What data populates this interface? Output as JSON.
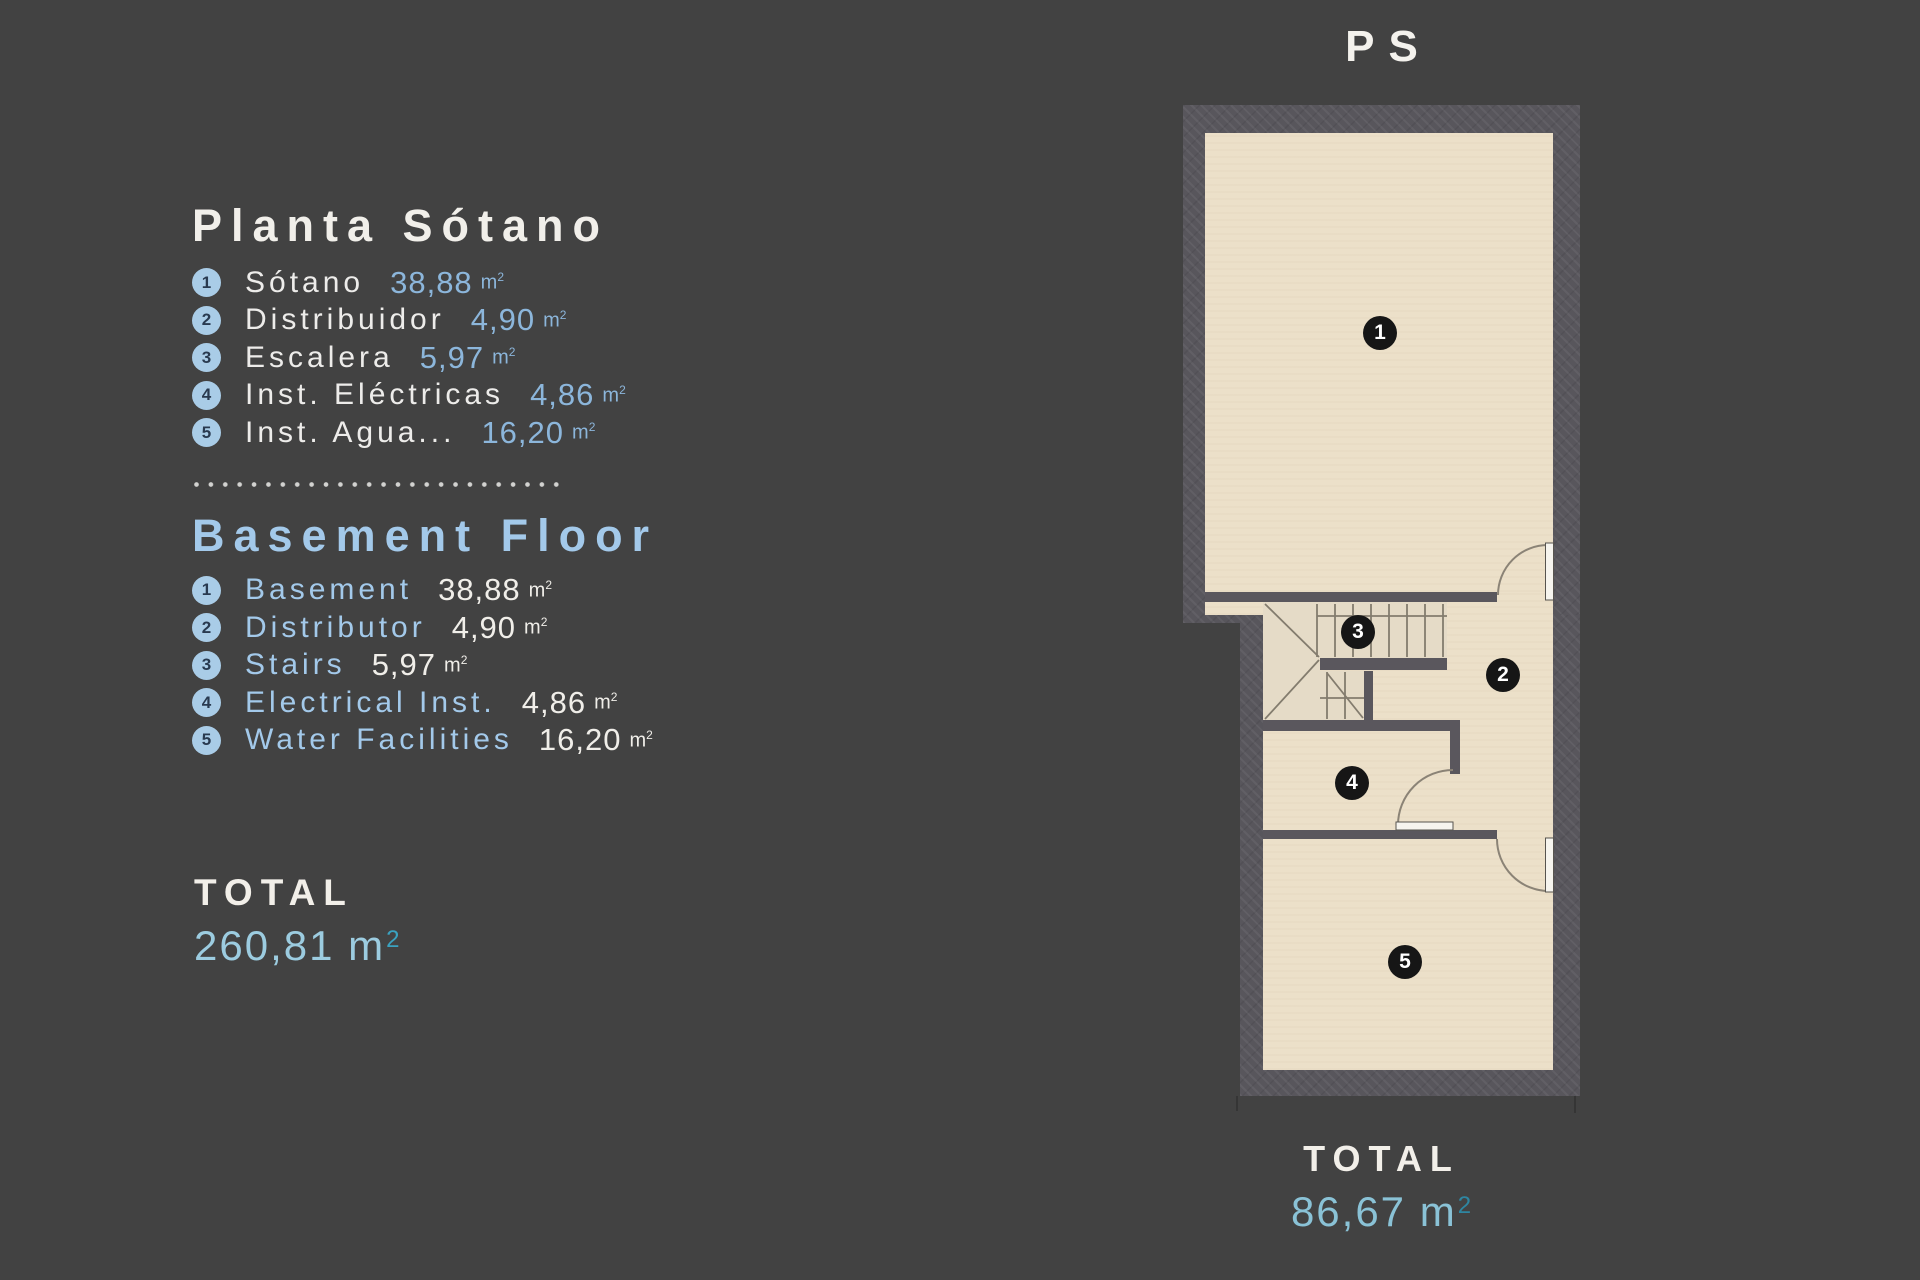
{
  "legend_es": {
    "title": "Planta Sótano",
    "unit": "m",
    "unit_sup": "2",
    "items": [
      {
        "num": "1",
        "label": "Sótano",
        "value": "38,88"
      },
      {
        "num": "2",
        "label": "Distribuidor",
        "value": "4,90"
      },
      {
        "num": "3",
        "label": "Escalera",
        "value": "5,97"
      },
      {
        "num": "4",
        "label": "Inst. Eléctricas",
        "value": "4,86"
      },
      {
        "num": "5",
        "label": "Inst. Agua...",
        "value": "16,20"
      }
    ]
  },
  "legend_en": {
    "title": "Basement Floor",
    "unit": "m",
    "unit_sup": "2",
    "items": [
      {
        "num": "1",
        "label": "Basement",
        "value": "38,88"
      },
      {
        "num": "2",
        "label": "Distributor",
        "value": "4,90"
      },
      {
        "num": "3",
        "label": "Stairs",
        "value": "5,97"
      },
      {
        "num": "4",
        "label": "Electrical Inst.",
        "value": "4,86"
      },
      {
        "num": "5",
        "label": "Water Facilities",
        "value": "16,20"
      }
    ]
  },
  "total_left": {
    "label": "TOTAL",
    "value": "260,81 m",
    "sup": "2"
  },
  "total_plan": {
    "label": "TOTAL",
    "value": "86,67 m",
    "sup": "2"
  },
  "plan": {
    "title": "PS",
    "markers": [
      "1",
      "2",
      "3",
      "4",
      "5"
    ]
  },
  "colors": {
    "background": "#424242",
    "wall": "#58565C",
    "floor": "#ECE0C9",
    "marker": "#161616",
    "accent_steel_blue": "#8CB6DB",
    "accent_light_blue": "#A3C9EA",
    "total_left_value": "#9CCCE0",
    "total_plan_value": "#8AC2D6",
    "superscript_teal": "#2E86A2",
    "text_white": "#F1EFEA"
  }
}
